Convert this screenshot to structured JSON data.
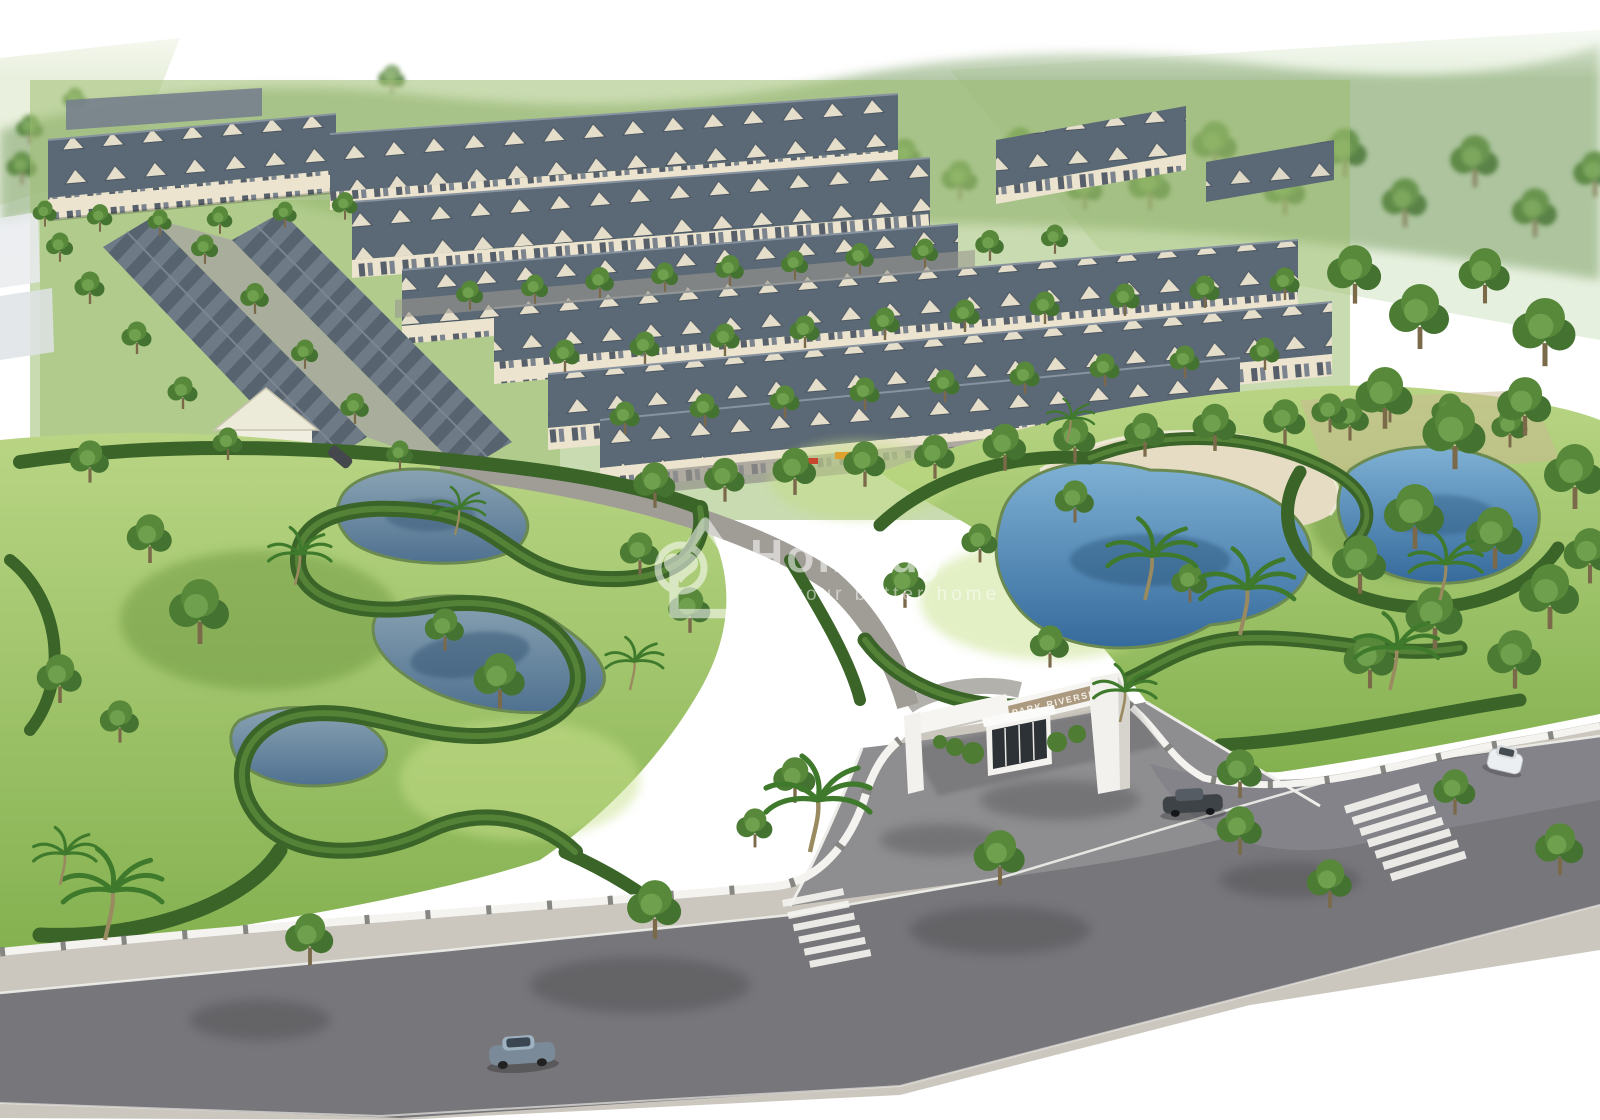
{
  "watermark": {
    "brand": "Homedy",
    "tagline": "Be your better home",
    "icon": "homedy-house-heart-logo",
    "color": "#ffffff"
  },
  "gate": {
    "sign": "PARK RIVERSIDE"
  },
  "icons": {
    "logo": "homedy-house-heart-logo"
  },
  "palette": {
    "sky": "#ffffff",
    "grass": "#9fc465",
    "grass_verge": "#8db45e",
    "hedge": "#3a6428",
    "canopy": "#4f7d33",
    "roof": "#5b6875",
    "roof_light": "#7e8894",
    "facade": "#ece4cf",
    "water_left": "#4f7190",
    "water_right": "#356a9c",
    "sand": "#e6dcc4",
    "road": "#77767a",
    "road_light": "#8e8d90",
    "sidewalk": "#cbc7bf",
    "wall": "#f4f3ef",
    "gate_white": "#f6f5f2",
    "gate_sign_panel": "#ac9a80",
    "play_red": "#cf4a36",
    "play_yellow": "#e2a42c"
  }
}
